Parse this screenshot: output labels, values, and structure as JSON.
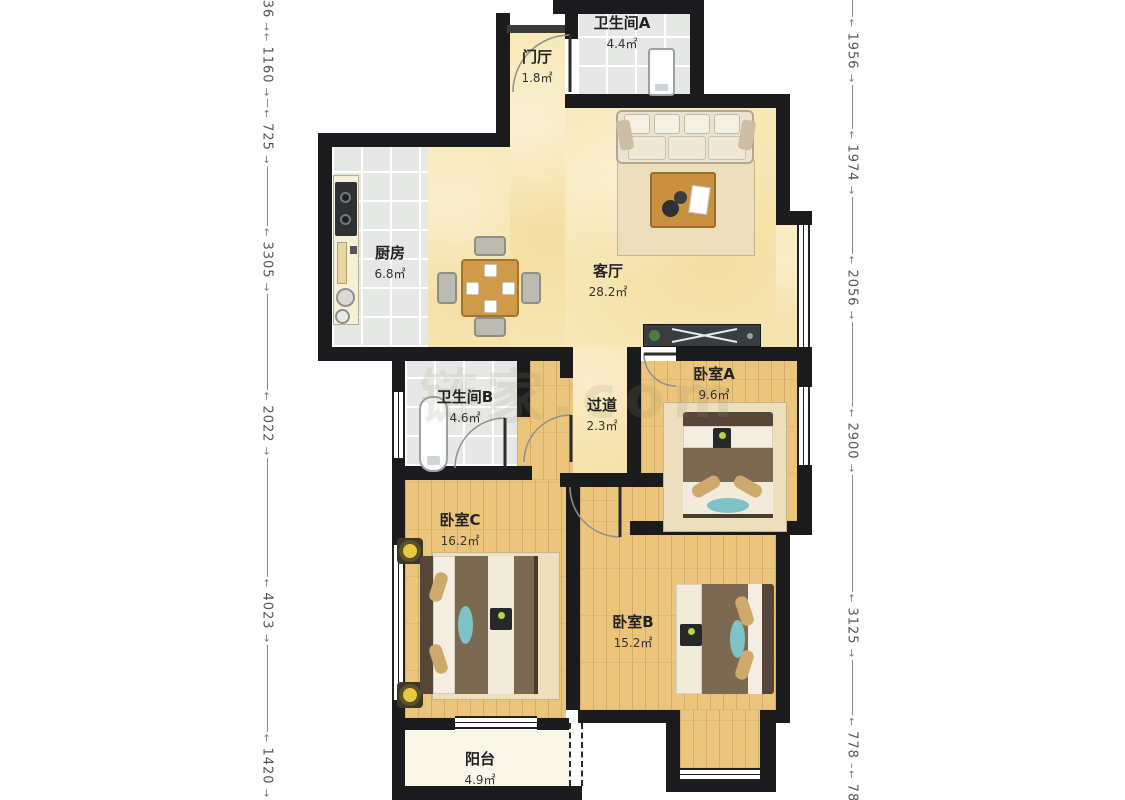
{
  "watermark": "链家.com",
  "rooms": {
    "bathroomA": {
      "name": "卫生间A",
      "area": "4.4㎡"
    },
    "foyer": {
      "name": "门厅",
      "area": "1.8㎡"
    },
    "kitchen": {
      "name": "厨房",
      "area": "6.8㎡"
    },
    "living": {
      "name": "客厅",
      "area": "28.2㎡"
    },
    "bathroomB": {
      "name": "卫生间B",
      "area": "4.6㎡"
    },
    "hallway": {
      "name": "过道",
      "area": "2.3㎡"
    },
    "bedroomA": {
      "name": "卧室A",
      "area": "9.6㎡"
    },
    "bedroomC": {
      "name": "卧室C",
      "area": "16.2㎡"
    },
    "bedroomB": {
      "name": "卧室B",
      "area": "15.2㎡"
    },
    "balcony": {
      "name": "阳台",
      "area": "4.9㎡"
    }
  },
  "dimensions": {
    "left": [
      "36",
      "1160",
      "725",
      "3305",
      "2022",
      "4023",
      "1420"
    ],
    "right": [
      "1956",
      "1974",
      "2056",
      "2900",
      "3125",
      "778",
      "78"
    ]
  },
  "colors": {
    "wall": "#1b1b1d",
    "wood_floor": "#eac57b",
    "tile_floor": "#e6e8e5",
    "living_floor": "#f7e8b6",
    "balcony_floor": "#fbf7e8",
    "accent_teal": "#7fc3c9",
    "table_wood": "#cf9a4a"
  }
}
